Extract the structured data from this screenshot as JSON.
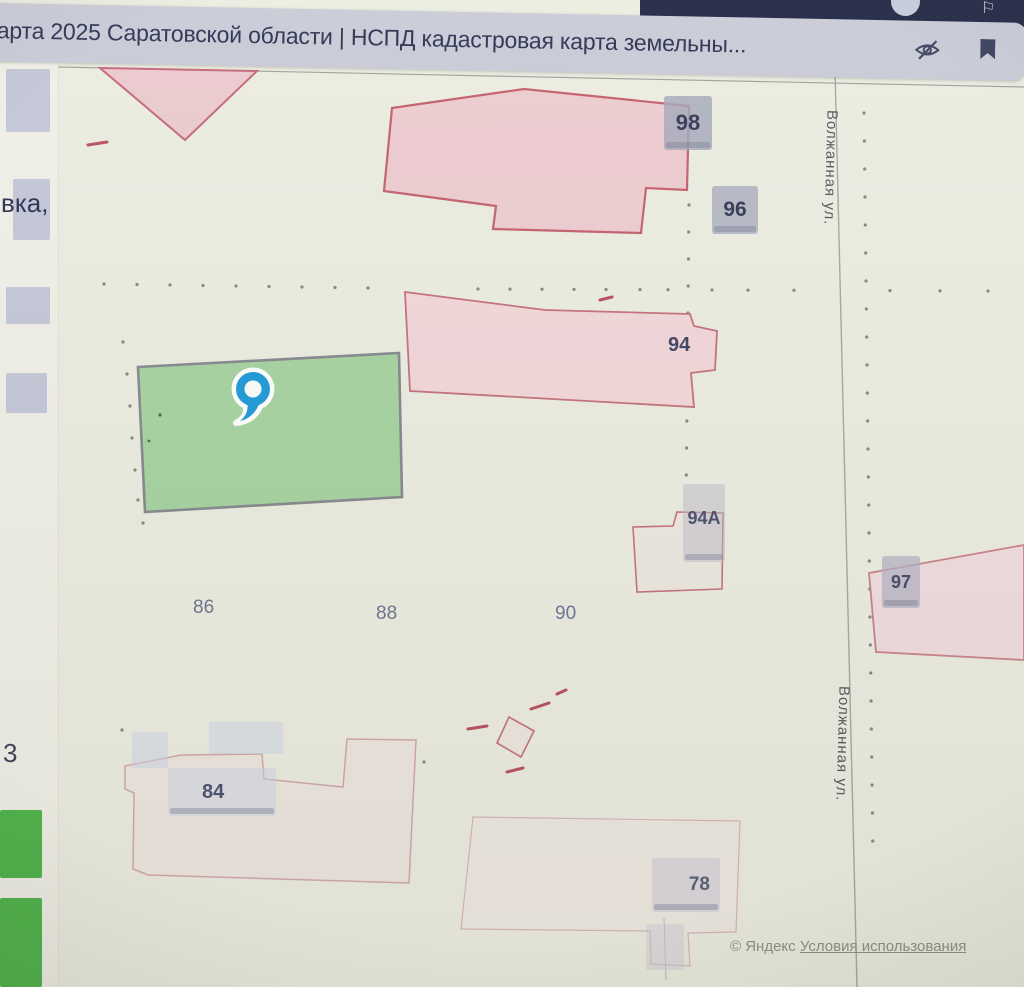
{
  "browser": {
    "tab_title": "карта 2025 Саратовской области | НСПД кадастровая карта земельны...",
    "icons": {
      "flag": "⚐"
    }
  },
  "sidebar": {
    "fragment_top": "вка,",
    "fragment_bottom": "3"
  },
  "map": {
    "house_numbers": {
      "n98": "98",
      "n96": "96",
      "n94": "94",
      "n94a": "94А",
      "n97": "97",
      "n86": "86",
      "n88": "88",
      "n90": "90",
      "n84": "84",
      "n78": "78"
    },
    "streets": {
      "volzhannaya_top": "Волжанная ул.",
      "volzhannaya_bottom": "Волжанная ул."
    },
    "attribution": {
      "provider": "© Яндекс",
      "terms": "Условия использования"
    },
    "colors": {
      "parcel_pink": "#edccd0",
      "parcel_border": "#c4717c",
      "selected_parcel_green": "#a6d3a0",
      "pin_blue": "#1f9ad9",
      "chrome_navy": "#232946"
    }
  }
}
